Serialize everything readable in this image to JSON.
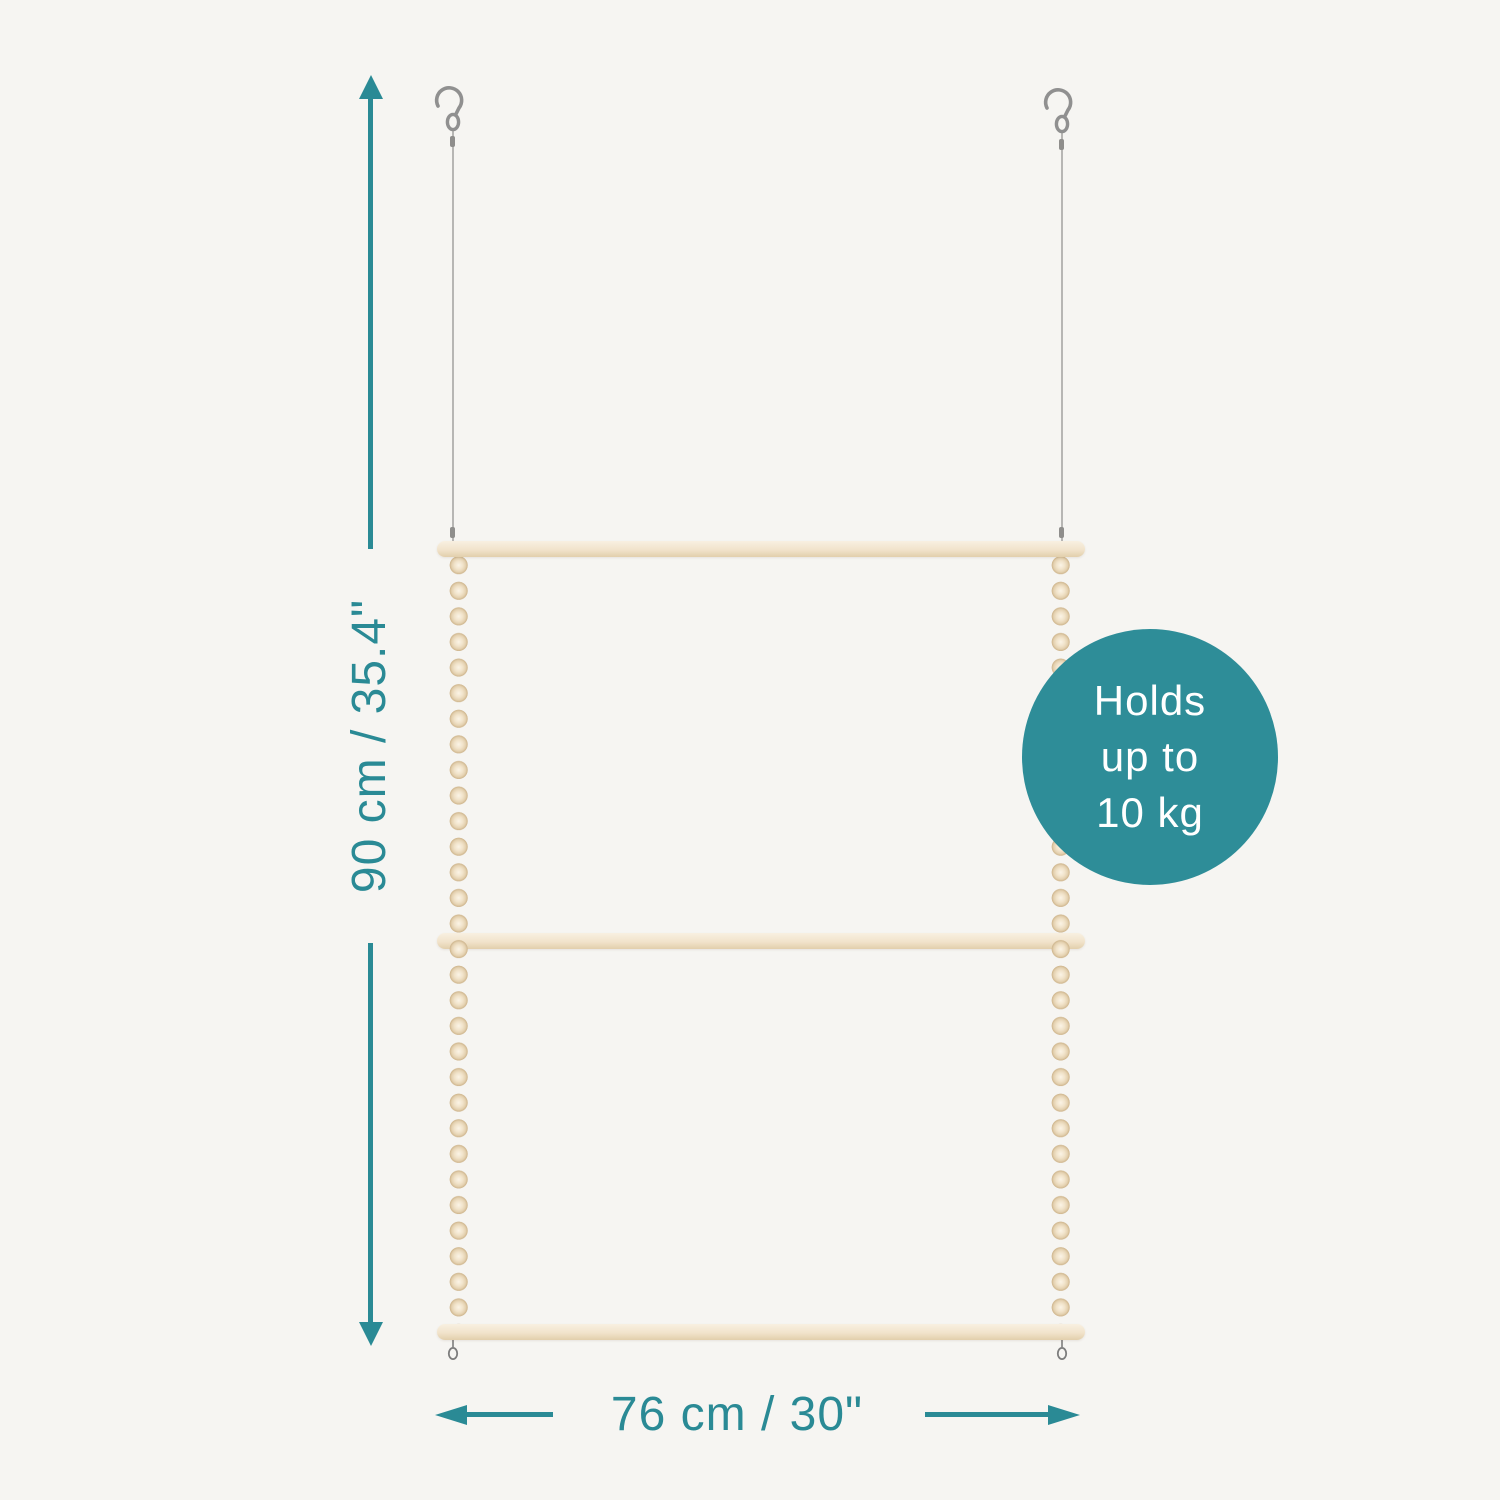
{
  "scene": {
    "background_color": "#f6f5f2",
    "accent_color": "#2a8a95",
    "wood_color": "#f1e3cb",
    "metal_color": "#8f8e8c"
  },
  "dimensions": {
    "height_label": "90 cm / 35.4\"",
    "width_label": "76 cm / 30\""
  },
  "badge": {
    "background_color": "#2e8d98",
    "text_color": "#ffffff",
    "lines": [
      "Holds",
      "up to",
      "10 kg"
    ]
  }
}
